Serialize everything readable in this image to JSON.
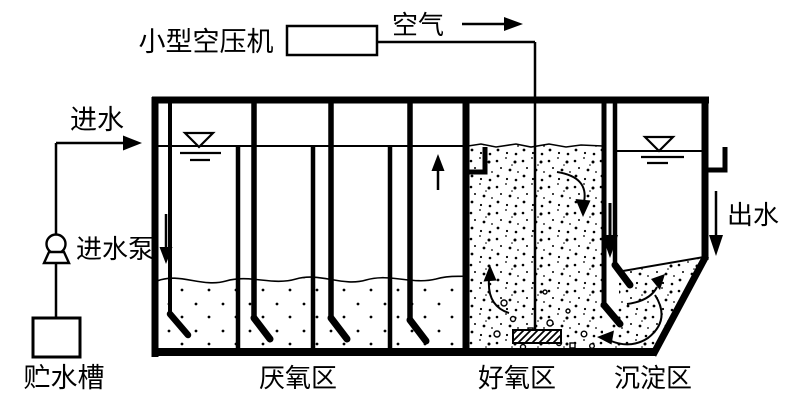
{
  "diagram": {
    "labels": {
      "compressor": "小型空压机",
      "air": "空气",
      "inlet": "进水",
      "inlet_pump": "进水泵",
      "storage_tank": "贮水槽",
      "zone_anaerobic": "厌氧区",
      "zone_aerobic": "好氧区",
      "zone_sedimentation": "沉淀区",
      "outlet": "出水"
    },
    "colors": {
      "line": "#000000",
      "background": "#ffffff"
    }
  }
}
